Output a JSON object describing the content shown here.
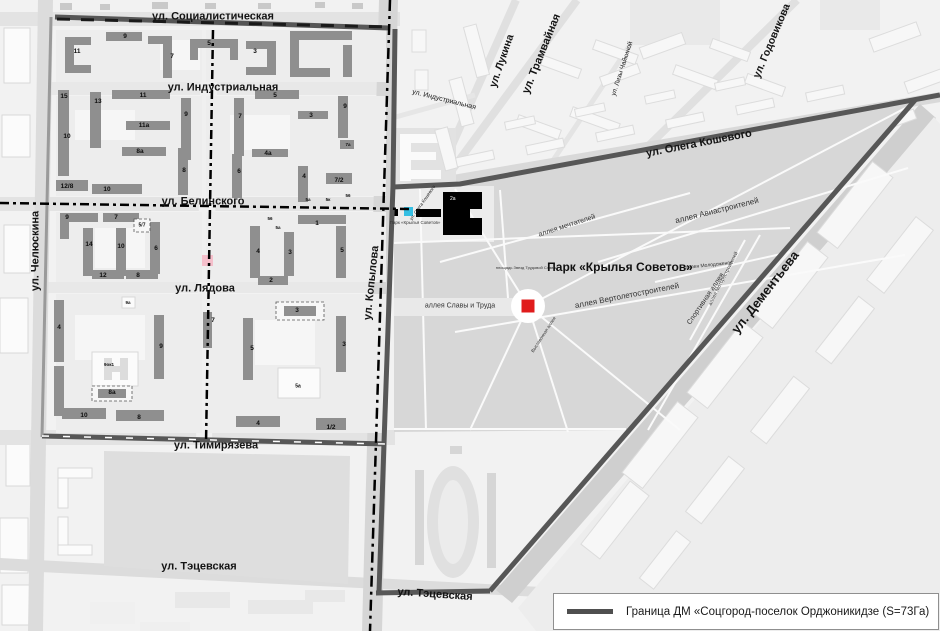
{
  "legend": {
    "label": "Граница ДМ «Соцгород-поселок Орджоникидзе (S=73Га)"
  },
  "colors": {
    "boundary": "#4f4f4f",
    "building_gray": "#8f8f8f",
    "park_gray": "#d7d7d7",
    "marker_red": "#e01c1c",
    "marker_cyan": "#35bfe3",
    "marker_pink": "#f5bfcb",
    "dk_black": "#000000"
  },
  "street_labels": [
    {
      "text": "ул. Социалистическая",
      "x": 213,
      "y": 17,
      "rot": 0,
      "size": 11,
      "bold": 1
    },
    {
      "text": "ул. Индустриальная",
      "x": 223,
      "y": 88,
      "rot": 0,
      "size": 11,
      "bold": 1
    },
    {
      "text": "ул. Белинского",
      "x": 203,
      "y": 202,
      "rot": 0,
      "size": 11,
      "bold": 1
    },
    {
      "text": "ул. Лядова",
      "x": 205,
      "y": 289,
      "rot": 0,
      "size": 11,
      "bold": 1
    },
    {
      "text": "ул. Тимирязева",
      "x": 216,
      "y": 446,
      "rot": 0,
      "size": 11,
      "bold": 1
    },
    {
      "text": "ул. Тэцевская",
      "x": 199,
      "y": 567,
      "rot": 0,
      "size": 11,
      "bold": 1
    },
    {
      "text": "ул. Тэцевская",
      "x": 435,
      "y": 595,
      "rot": 4,
      "size": 11,
      "bold": 1
    },
    {
      "text": "ул. Челюскина",
      "x": 36,
      "y": 251,
      "rot": -90,
      "size": 11,
      "bold": 1
    },
    {
      "text": "ул. Копылова",
      "x": 372,
      "y": 283,
      "rot": -84,
      "size": 11,
      "bold": 1
    },
    {
      "text": "ул. Индустриальная",
      "x": 444,
      "y": 100,
      "rot": 14,
      "size": 7,
      "bold": 0
    },
    {
      "text": "ул. Лукина",
      "x": 502,
      "y": 61,
      "rot": -71,
      "size": 10.5,
      "bold": 1
    },
    {
      "text": "ул. Трамвайная",
      "x": 542,
      "y": 54,
      "rot": -68,
      "size": 11,
      "bold": 1
    },
    {
      "text": "ул. Лизы Чайкиной",
      "x": 623,
      "y": 69,
      "rot": -72,
      "size": 6.5,
      "bold": 0
    },
    {
      "text": "ул. Годовикова",
      "x": 772,
      "y": 41,
      "rot": -67,
      "size": 10.5,
      "bold": 1
    },
    {
      "text": "ул. Олега Кошевого",
      "x": 699,
      "y": 144,
      "rot": -11,
      "size": 11,
      "bold": 1
    },
    {
      "text": "ул. Олега Кошевого",
      "x": 423,
      "y": 203,
      "rot": -55,
      "size": 4.5,
      "bold": 0
    },
    {
      "text": "ул. Дементьева",
      "x": 765,
      "y": 292,
      "rot": -52,
      "size": 13,
      "bold": 1
    }
  ],
  "park": {
    "title": {
      "text": "Парк «Крылья Советов»",
      "x": 620,
      "y": 267,
      "rot": 0,
      "size": 12,
      "bold": 1
    },
    "alley_labels": [
      {
        "text": "аллея мечтателей",
        "x": 567,
        "y": 226,
        "rot": -18,
        "size": 7
      },
      {
        "text": "аллея Авиастроителей",
        "x": 717,
        "y": 211,
        "rot": -14,
        "size": 8
      },
      {
        "text": "аллея Молодоженов",
        "x": 709,
        "y": 266,
        "rot": -6,
        "size": 5
      },
      {
        "text": "аллея Вертолетостроителей",
        "x": 627,
        "y": 296,
        "rot": -11,
        "size": 8
      },
      {
        "text": "Спортивная аллея",
        "x": 706,
        "y": 299,
        "rot": -56,
        "size": 7
      },
      {
        "text": "аллея Моторостроителей",
        "x": 724,
        "y": 279,
        "rot": -63,
        "size": 5
      },
      {
        "text": "аллея Славы и Труда",
        "x": 460,
        "y": 306,
        "rot": 0,
        "size": 7
      },
      {
        "text": "площадь Звезд Трудовой Славы",
        "x": 526,
        "y": 268,
        "rot": 0,
        "size": 4
      },
      {
        "text": "Выставочная аллея",
        "x": 544,
        "y": 335,
        "rot": -57,
        "size": 4.5
      },
      {
        "text": "Парк «Крылья Советов»",
        "x": 415,
        "y": 223,
        "rot": 0,
        "size": 4.5
      }
    ]
  },
  "building_numbers": [
    {
      "t": "11",
      "x": 77,
      "y": 52
    },
    {
      "t": "9",
      "x": 125,
      "y": 37
    },
    {
      "t": "7",
      "x": 172,
      "y": 57
    },
    {
      "t": "5",
      "x": 209,
      "y": 44
    },
    {
      "t": "3",
      "x": 255,
      "y": 52
    },
    {
      "t": "15",
      "x": 64,
      "y": 97
    },
    {
      "t": "13",
      "x": 98,
      "y": 102
    },
    {
      "t": "11",
      "x": 143,
      "y": 96
    },
    {
      "t": "9",
      "x": 186,
      "y": 115
    },
    {
      "t": "10",
      "x": 67,
      "y": 137
    },
    {
      "t": "11а",
      "x": 144,
      "y": 126
    },
    {
      "t": "8а",
      "x": 140,
      "y": 152
    },
    {
      "t": "12/8",
      "x": 67,
      "y": 187
    },
    {
      "t": "10",
      "x": 107,
      "y": 190
    },
    {
      "t": "8",
      "x": 184,
      "y": 171
    },
    {
      "t": "5",
      "x": 275,
      "y": 96
    },
    {
      "t": "7",
      "x": 240,
      "y": 117
    },
    {
      "t": "3",
      "x": 311,
      "y": 116
    },
    {
      "t": "9",
      "x": 345,
      "y": 107
    },
    {
      "t": "4а",
      "x": 268,
      "y": 154
    },
    {
      "t": "6",
      "x": 239,
      "y": 172
    },
    {
      "t": "4",
      "x": 304,
      "y": 177
    },
    {
      "t": "7а",
      "x": 348,
      "y": 145,
      "s": 4.5
    },
    {
      "t": "7/2",
      "x": 339,
      "y": 181
    },
    {
      "t": "5а",
      "x": 308,
      "y": 200,
      "s": 4.5
    },
    {
      "t": "5к",
      "x": 328,
      "y": 200,
      "s": 4.5
    },
    {
      "t": "56",
      "x": 348,
      "y": 196,
      "s": 4.5
    },
    {
      "t": "9",
      "x": 67,
      "y": 218
    },
    {
      "t": "7",
      "x": 116,
      "y": 218
    },
    {
      "t": "5/7",
      "x": 142,
      "y": 226,
      "s": 5
    },
    {
      "t": "14",
      "x": 89,
      "y": 245
    },
    {
      "t": "10",
      "x": 121,
      "y": 247
    },
    {
      "t": "6",
      "x": 156,
      "y": 249
    },
    {
      "t": "12",
      "x": 103,
      "y": 276
    },
    {
      "t": "8",
      "x": 138,
      "y": 276
    },
    {
      "t": "1",
      "x": 317,
      "y": 224
    },
    {
      "t": "4",
      "x": 258,
      "y": 252
    },
    {
      "t": "3",
      "x": 290,
      "y": 253
    },
    {
      "t": "5",
      "x": 342,
      "y": 251
    },
    {
      "t": "2",
      "x": 271,
      "y": 281
    },
    {
      "t": "56",
      "x": 270,
      "y": 219,
      "s": 4.5
    },
    {
      "t": "5а",
      "x": 278,
      "y": 228,
      "s": 4.5
    },
    {
      "t": "4",
      "x": 59,
      "y": 328
    },
    {
      "t": "9а",
      "x": 128,
      "y": 303,
      "s": 4.5
    },
    {
      "t": "9",
      "x": 161,
      "y": 347
    },
    {
      "t": "7",
      "x": 213,
      "y": 321
    },
    {
      "t": "9ок1",
      "x": 109,
      "y": 365,
      "s": 4.5
    },
    {
      "t": "8а",
      "x": 112,
      "y": 393
    },
    {
      "t": "10",
      "x": 84,
      "y": 416
    },
    {
      "t": "8",
      "x": 139,
      "y": 418
    },
    {
      "t": "5",
      "x": 252,
      "y": 349
    },
    {
      "t": "3",
      "x": 297,
      "y": 311
    },
    {
      "t": "3",
      "x": 344,
      "y": 345
    },
    {
      "t": "5а",
      "x": 298,
      "y": 387,
      "s": 5
    },
    {
      "t": "4",
      "x": 258,
      "y": 424
    },
    {
      "t": "1/2",
      "x": 331,
      "y": 428
    }
  ],
  "markers": {
    "dk_label": "2а"
  }
}
